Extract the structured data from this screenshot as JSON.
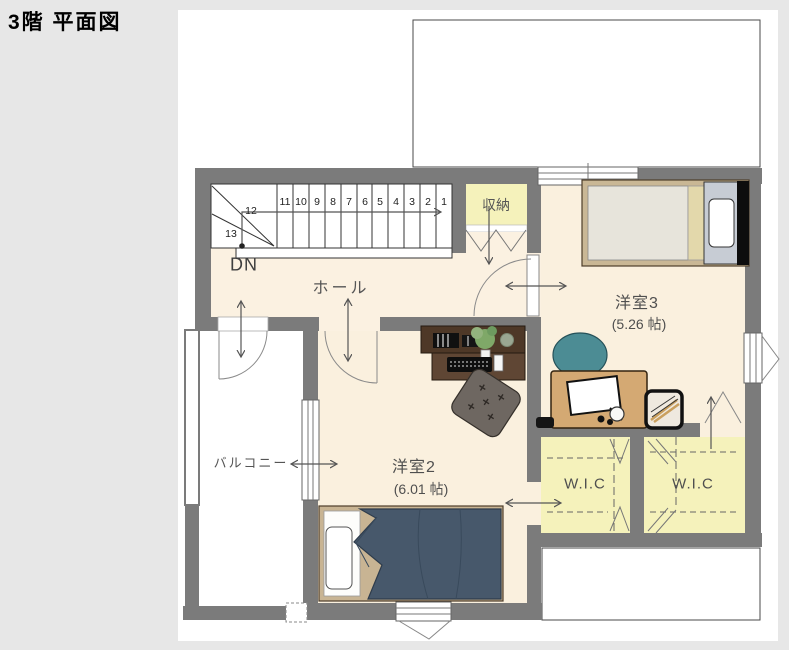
{
  "title": "3階 平面図",
  "rooms": {
    "hall": {
      "label": "ホール"
    },
    "storage": {
      "label": "収納"
    },
    "room3": {
      "label": "洋室3",
      "size": "(5.26 帖)"
    },
    "room2": {
      "label": "洋室2",
      "size": "(6.01 帖)"
    },
    "balcony": {
      "label": "バルコニー"
    },
    "wic_left": {
      "label": "W.I.C"
    },
    "wic_right": {
      "label": "W.I.C"
    }
  },
  "stairs": {
    "direction_label": "DN",
    "step_numbers": [
      "1",
      "2",
      "3",
      "4",
      "5",
      "6",
      "7",
      "8",
      "9",
      "10",
      "11",
      "12",
      "13"
    ]
  },
  "colors": {
    "page_bg": "#e7e7e7",
    "plan_bg": "#ffffff",
    "wall": "#7b7b7b",
    "room_floor": "#fbf1e1",
    "closet_floor": "#f5f2bb",
    "balcony_floor": "#ffffff",
    "bed_duvet": "#47586b",
    "bed_frame": "#c8b493",
    "chair": "#4c8c94",
    "desk_dark": "#4e3827",
    "desk_tan": "#d4a973",
    "line": "#555555"
  }
}
